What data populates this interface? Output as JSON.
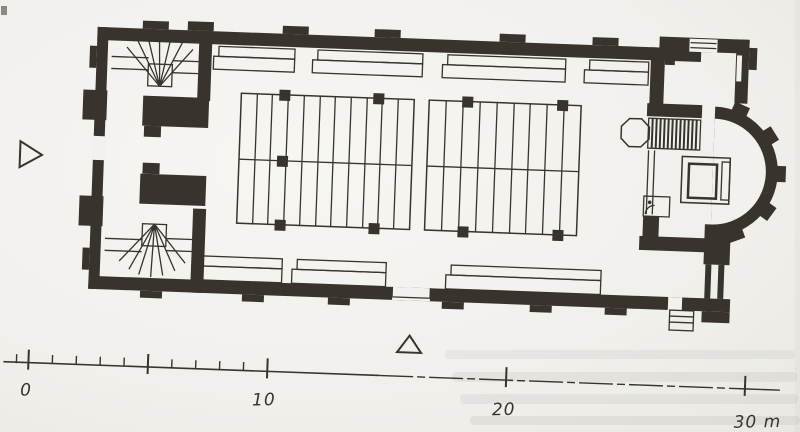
{
  "colors": {
    "ink": "#38332c",
    "paper": "#f3f1ed"
  },
  "scan": {
    "rotation_deg": 2.1
  },
  "scale_bar": {
    "labels": {
      "zero": "0",
      "ten": "10",
      "twenty": "20",
      "thirty": "30 m"
    },
    "unit": "m",
    "origin_x": 41,
    "pixels_per_meter": 23.9,
    "baseline_y": 365,
    "major_ticks_m": [
      0,
      5,
      10,
      20,
      30
    ],
    "minor_ticks_max_m": 9,
    "pre_tick_offset_px": 12
  },
  "markers": {
    "west_entrance_arrow": "open-triangle-pointing-right",
    "south_entrance_arrow": "open-triangle-pointing-up"
  },
  "plan_features": {
    "northwest_corner": "winder-staircase",
    "southwest_corner": "winder-staircase",
    "west_end": "entrance-vestibule-with-piers",
    "nave": "two-pew-blocks-with-columns",
    "walls": "gallery-window-strips",
    "chancel": "octagonal-pulpit-and-hatched-steps",
    "sanctuary": "altar",
    "east_end": "semicircular-apse-with-buttresses",
    "southeast_exterior": "outside-steps"
  }
}
